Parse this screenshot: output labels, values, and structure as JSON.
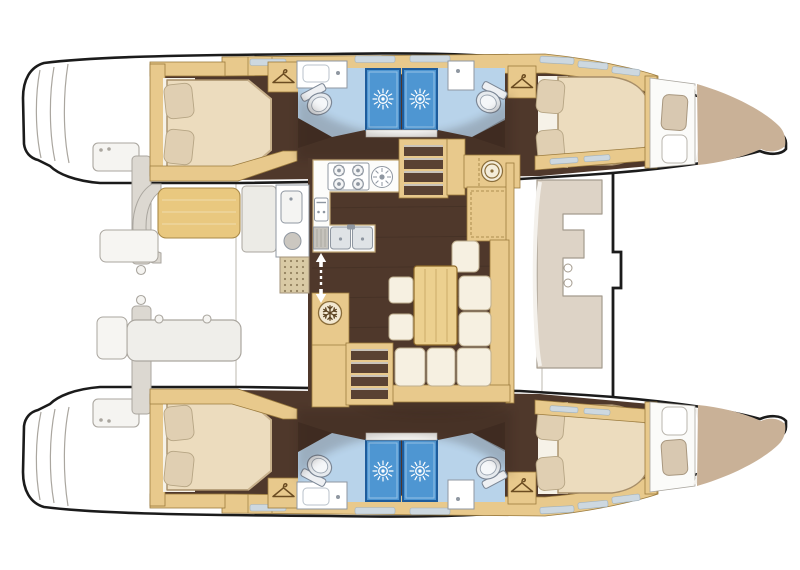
{
  "meta": {
    "subject": "catamaran-yacht-floor-plan",
    "view": "overhead deck and accommodation layout",
    "orientation": "bow-right",
    "hulls": 2,
    "symmetry": "port and starboard hulls mirrored"
  },
  "palette": {
    "hull": "#1b1b1b",
    "exline": "#aaa69f",
    "exfill": "#f5f4f1",
    "panel": "#dcd8d1",
    "wood": "#e8c98c",
    "woodEdge": "#9b7b3e",
    "woodLight": "#f0dcae",
    "teak": "#e9c87f",
    "floor": "#4f382b",
    "mattress": "#ecdcbe",
    "mattressEdge": "#a78e69",
    "pillow": "#e0cfb2",
    "settee": "#f6f0e1",
    "setteeEdge": "#beae8e",
    "headFloor": "#b8d3ea",
    "shower": "#4e96d2",
    "showerEdge": "#1e5c9c",
    "fixWhite": "#ffffff",
    "fixStroke": "#8f97a1",
    "sinkSteel": "#dfe3e6",
    "bowDeck": "#c9b197",
    "taupeCushion": "#d8c8b1",
    "tableWood": "#ecd08f",
    "windowSlit": "#cdd8e0",
    "grateBase": "#d9caa5",
    "grateDot": "#93815f",
    "stepBrown": "#5a4233",
    "stepTread": "#cac4ba",
    "shadow": "#2a1d13",
    "arrow": "#ffffff"
  },
  "fixtures": [
    {
      "name": "double-berth-cabin",
      "count": 4
    },
    {
      "name": "head-compartment",
      "count": 4
    },
    {
      "name": "toilet",
      "count": 4,
      "icon": "toilet"
    },
    {
      "name": "washbasin-counter",
      "count": 4,
      "icon": "basin-dot"
    },
    {
      "name": "shower-stall",
      "count": 4,
      "icon": "shower-rose-sunburst"
    },
    {
      "name": "hanging-locker",
      "count": 4,
      "icon": "hanger"
    },
    {
      "name": "stove-burner",
      "count": 4,
      "icon": "burner-ring"
    },
    {
      "name": "round-hob",
      "count": 1,
      "icon": "spoked-circle"
    },
    {
      "name": "oven",
      "count": 1
    },
    {
      "name": "galley-double-sink",
      "count": 1
    },
    {
      "name": "fridge",
      "count": 1,
      "icon": "snowflake"
    },
    {
      "name": "companionway-stairs",
      "count": 2,
      "icon": "steps"
    },
    {
      "name": "salon-dinette-table",
      "count": 1
    },
    {
      "name": "salon-settee-cushion",
      "count": 8
    },
    {
      "name": "ottoman-stool",
      "count": 2
    },
    {
      "name": "nav-station",
      "count": 1,
      "icon": "spoked-circle"
    },
    {
      "name": "sliding-door",
      "count": 1,
      "icon": "double-arrow"
    },
    {
      "name": "teak-grate",
      "count": 1,
      "icon": "dot-grid"
    },
    {
      "name": "cockpit-wet-bar",
      "count": 1
    },
    {
      "name": "cockpit-bench",
      "count": 1
    },
    {
      "name": "cockpit-table",
      "count": 1
    },
    {
      "name": "foredeck-seat",
      "count": 1,
      "icon": "cupholder-circles"
    },
    {
      "name": "bow-deck",
      "count": 2
    },
    {
      "name": "trampoline",
      "count": 1
    }
  ]
}
